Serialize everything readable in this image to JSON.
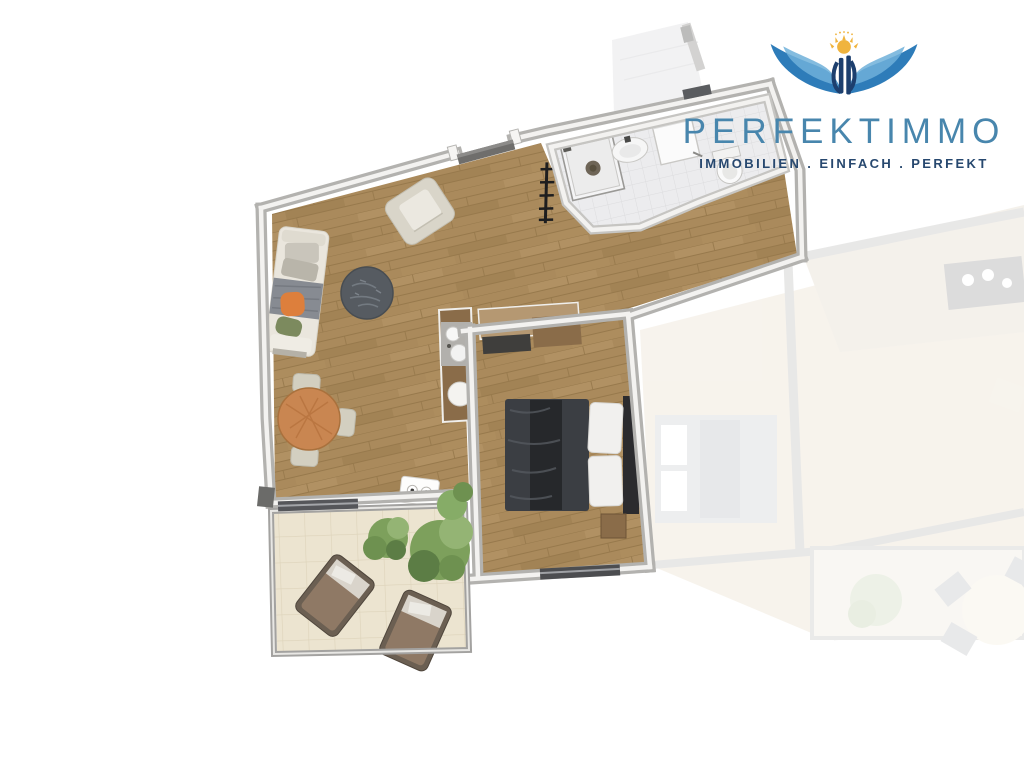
{
  "logo": {
    "brand": "PERFEKTIMMO",
    "tagline": "IMMOBILIEN . EINFACH . PERFEKT",
    "icon": "eagle-wings-sun-emblem"
  },
  "floorplan": {
    "type": "apartment-top-view-render",
    "visible_rooms": [
      "living-dining-room",
      "kitchenette",
      "bedroom",
      "bathroom",
      "terrace"
    ],
    "ghosted_area": "adjacent-unit-faded"
  },
  "colors": {
    "brand_blue": "#4886ad",
    "tagline_navy": "#27486f",
    "wing_blue": "#2e7cb9",
    "wing_light": "#6fb0d9",
    "sun_gold": "#f0b43e",
    "monogram_navy": "#1d3f6e",
    "wall_gray": "#b3b2af",
    "wall_light": "#f3f2f0",
    "wood_floor": "#aa8a5c",
    "wood_line": "#97794c",
    "bath_tile": "#ececee",
    "bath_line": "#dcdcde",
    "terrace_tile": "#ece4d0",
    "terrace_line": "#ddd3ba",
    "terrace_wall": "#a3a2a0",
    "sofa_cream": "#eae6dd",
    "blanket_gray": "#878b92",
    "pillow_orange": "#dd7f3c",
    "pillow_green": "#7c8a5e",
    "coffee_table": "#565b61",
    "dining_wood": "#c98651",
    "chair_beige": "#d3cfc0",
    "bed_duvet": "#3b3e43",
    "bed_throw": "#26282b",
    "pillow_white": "#f1f0ee",
    "wood_furniture": "#8a6c49",
    "plant_green": "#7da05c",
    "lounger_brown": "#8f7965"
  }
}
